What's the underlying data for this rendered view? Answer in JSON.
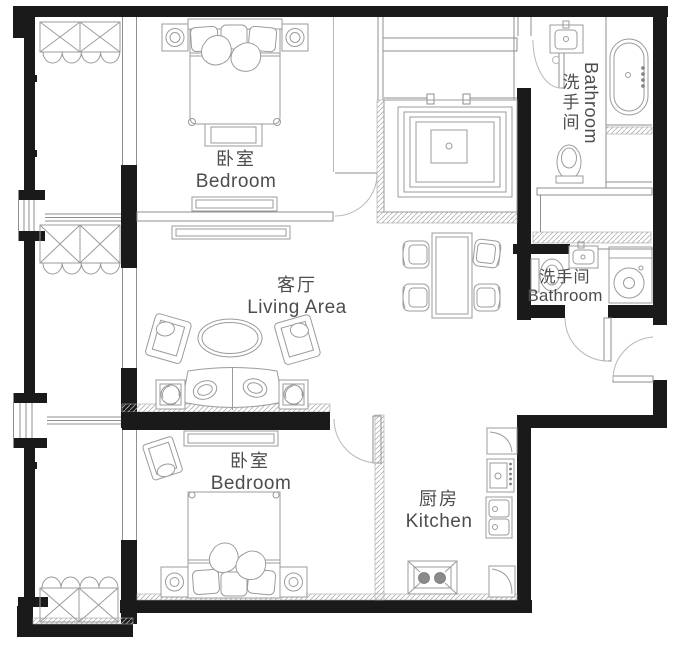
{
  "title": "apartment-floor-plan",
  "rooms": {
    "bedroom_top": {
      "zh": "卧室",
      "en": "Bedroom"
    },
    "living": {
      "zh": "客厅",
      "en": "Living Area"
    },
    "bedroom_bottom": {
      "zh": "卧室",
      "en": "Bedroom"
    },
    "kitchen": {
      "zh": "厨房",
      "en": "Kitchen"
    },
    "bathroom_top": {
      "zh": "洗手间",
      "en": "Bathroom"
    },
    "bathroom_middle": {
      "zh": "洗手间",
      "en": "Bathroom"
    }
  },
  "palette": {
    "wall_color": "#1a1a1a",
    "furniture_line_color": "#9b9b9b",
    "label_color": "#4d4d4d",
    "background": "#ffffff"
  }
}
